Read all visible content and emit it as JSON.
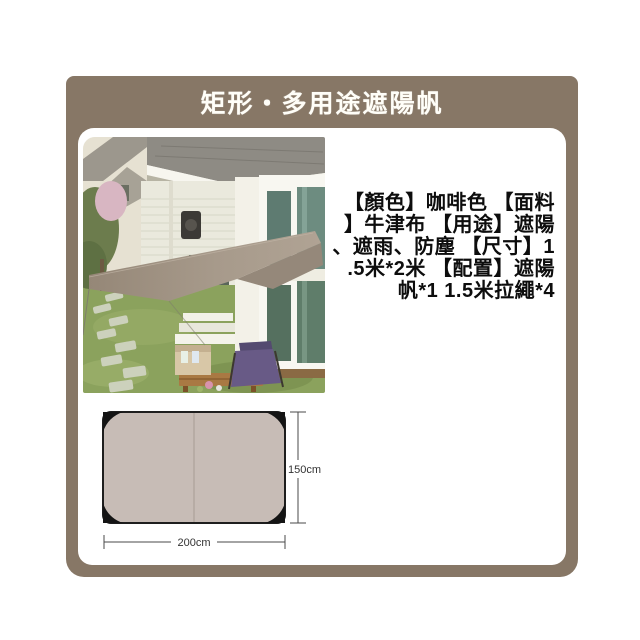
{
  "header": {
    "title": "矩形・多用途遮陽帆"
  },
  "product": {
    "description_full": "【顏色】咖啡色 【面料】牛津布 【用途】遮陽、遮雨、防塵 【尺寸】1.5米*2米 【配置】遮陽帆*1 1.5米拉繩*4",
    "description_lines": [
      "【顏色】咖啡色 【面料",
      "】牛津布 【用途】遮陽",
      "、遮雨、防塵 【尺寸】1",
      ".5米*2米 【配置】遮陽",
      "帆*1 1.5米拉繩*4"
    ]
  },
  "diagram": {
    "width_label": "200cm",
    "height_label": "150cm"
  },
  "colors": {
    "panel_taupe": "#877766",
    "tarp_diagram_fill": "#c7bcb6",
    "sail_brown": "#a39484",
    "body_text": "#0d0d0d",
    "title_text": "#fffef8"
  }
}
